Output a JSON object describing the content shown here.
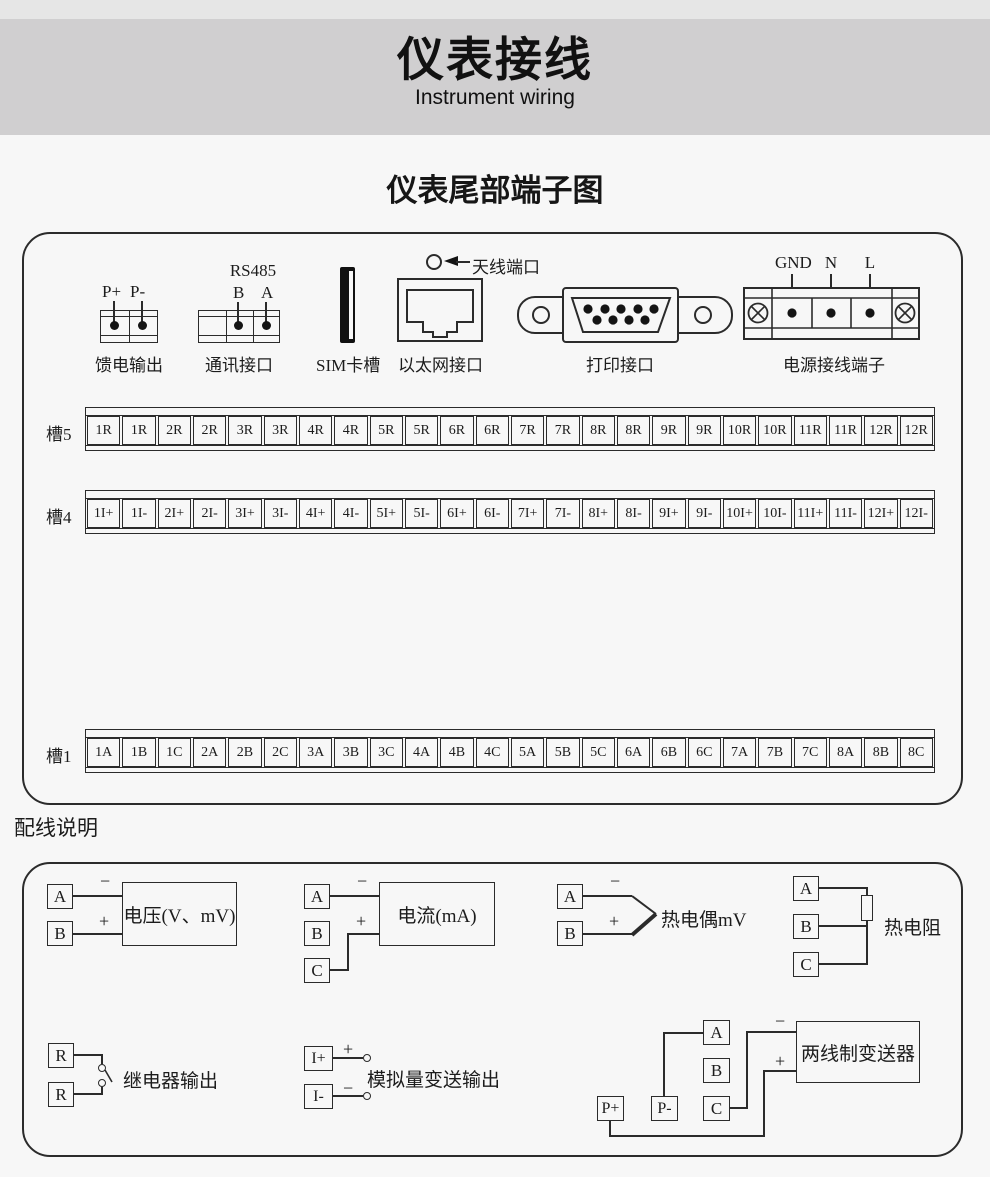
{
  "header": {
    "title": "仪表接线",
    "subtitle": "Instrument wiring"
  },
  "section_title": "仪表尾部端子图",
  "signs": {
    "plus": "+",
    "minus": "−"
  },
  "connectors": {
    "feed": {
      "label": "馈电输出",
      "pins": [
        "P+",
        "P-"
      ]
    },
    "comm": {
      "label": "通讯接口",
      "protocol": "RS485",
      "pins": [
        "B",
        "A"
      ]
    },
    "sim": {
      "label": "SIM卡槽"
    },
    "ethernet": {
      "label": "以太网接口"
    },
    "antenna": {
      "label": "天线端口"
    },
    "printer": {
      "label": "打印接口"
    },
    "power": {
      "label": "电源接线端子",
      "pins": [
        "GND",
        "N",
        "L"
      ]
    }
  },
  "slots": [
    {
      "name": "槽5",
      "cells": [
        "1R",
        "1R",
        "2R",
        "2R",
        "3R",
        "3R",
        "4R",
        "4R",
        "5R",
        "5R",
        "6R",
        "6R",
        "7R",
        "7R",
        "8R",
        "8R",
        "9R",
        "9R",
        "10R",
        "10R",
        "11R",
        "11R",
        "12R",
        "12R"
      ]
    },
    {
      "name": "槽4",
      "cells": [
        "1I+",
        "1I-",
        "2I+",
        "2I-",
        "3I+",
        "3I-",
        "4I+",
        "4I-",
        "5I+",
        "5I-",
        "6I+",
        "6I-",
        "7I+",
        "7I-",
        "8I+",
        "8I-",
        "9I+",
        "9I-",
        "10I+",
        "10I-",
        "11I+",
        "11I-",
        "12I+",
        "12I-"
      ]
    },
    {
      "name": "槽1",
      "cells": [
        "1A",
        "1B",
        "1C",
        "2A",
        "2B",
        "2C",
        "3A",
        "3B",
        "3C",
        "4A",
        "4B",
        "4C",
        "5A",
        "5B",
        "5C",
        "6A",
        "6B",
        "6C",
        "7A",
        "7B",
        "7C",
        "8A",
        "8B",
        "8C"
      ]
    }
  ],
  "wiring": {
    "title": "配线说明",
    "voltage": {
      "a": "A",
      "b": "B",
      "label": "电压(V、mV)"
    },
    "current": {
      "a": "A",
      "b": "B",
      "c": "C",
      "label": "电流(mA)"
    },
    "thermocouple": {
      "a": "A",
      "b": "B",
      "label": "热电偶mV"
    },
    "rtd": {
      "a": "A",
      "b": "B",
      "c": "C",
      "label": "热电阻"
    },
    "relay": {
      "r1": "R",
      "r2": "R",
      "label": "继电器输出"
    },
    "analog": {
      "ip": "I+",
      "im": "I-",
      "label": "模拟量变送输出"
    },
    "transmitter": {
      "a": "A",
      "b": "B",
      "c": "C",
      "pp": "P+",
      "pm": "P-",
      "label": "两线制变送器"
    }
  }
}
